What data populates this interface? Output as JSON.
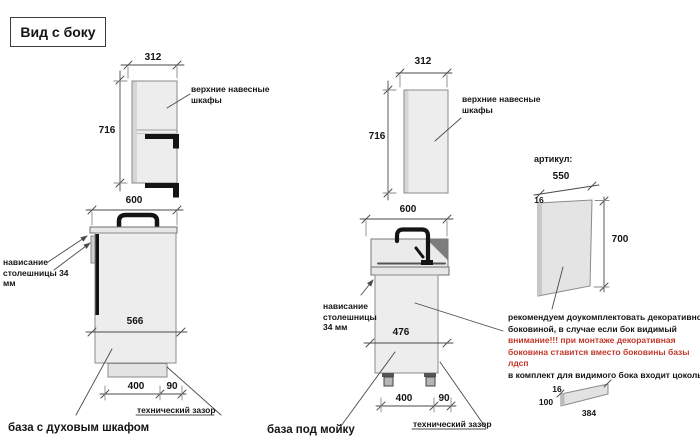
{
  "title": "Вид с боку",
  "colors": {
    "warning_text": "#c0392b",
    "drawing_fill": "#ededed",
    "accent_black": "#141414",
    "line": "#4a4a4a"
  },
  "wall_cabinet_left": {
    "width_mm": "312",
    "height_mm": "716",
    "label": "верхние навесные шкафы"
  },
  "base_oven": {
    "width_mm": "600",
    "inner_mm": "566",
    "plinth_mm": "400",
    "gap_mm": "90",
    "overhang_label": "нависание столешницы 34 мм",
    "gap_label": "технический зазор",
    "caption": "база с духовым шкафом"
  },
  "wall_cabinet_mid": {
    "width_mm": "312",
    "height_mm": "716",
    "label": "верхние навесные шкафы"
  },
  "base_sink": {
    "width_mm": "600",
    "inner_mm": "476",
    "plinth_mm": "400",
    "gap_mm": "90",
    "overhang_label": "нависание столешницы 34 мм",
    "gap_label": "технический зазор",
    "caption": "база под мойку"
  },
  "side_panel": {
    "article_label": "артикул:",
    "width_mm": "550",
    "thickness_mm": "16",
    "height_mm": "700"
  },
  "note": {
    "recommendation": "рекомендуем доукомплектовать декоративной боковиной, в случае если бок видимый",
    "warning": "внимание!!! при монтаже декоративная боковина ставится вместо боковины базы лдсп",
    "kit": "в комплект для видимого бока входит цоколь:"
  },
  "plinth_strip": {
    "thickness_mm": "16",
    "height_mm": "100",
    "length_mm": "384"
  }
}
